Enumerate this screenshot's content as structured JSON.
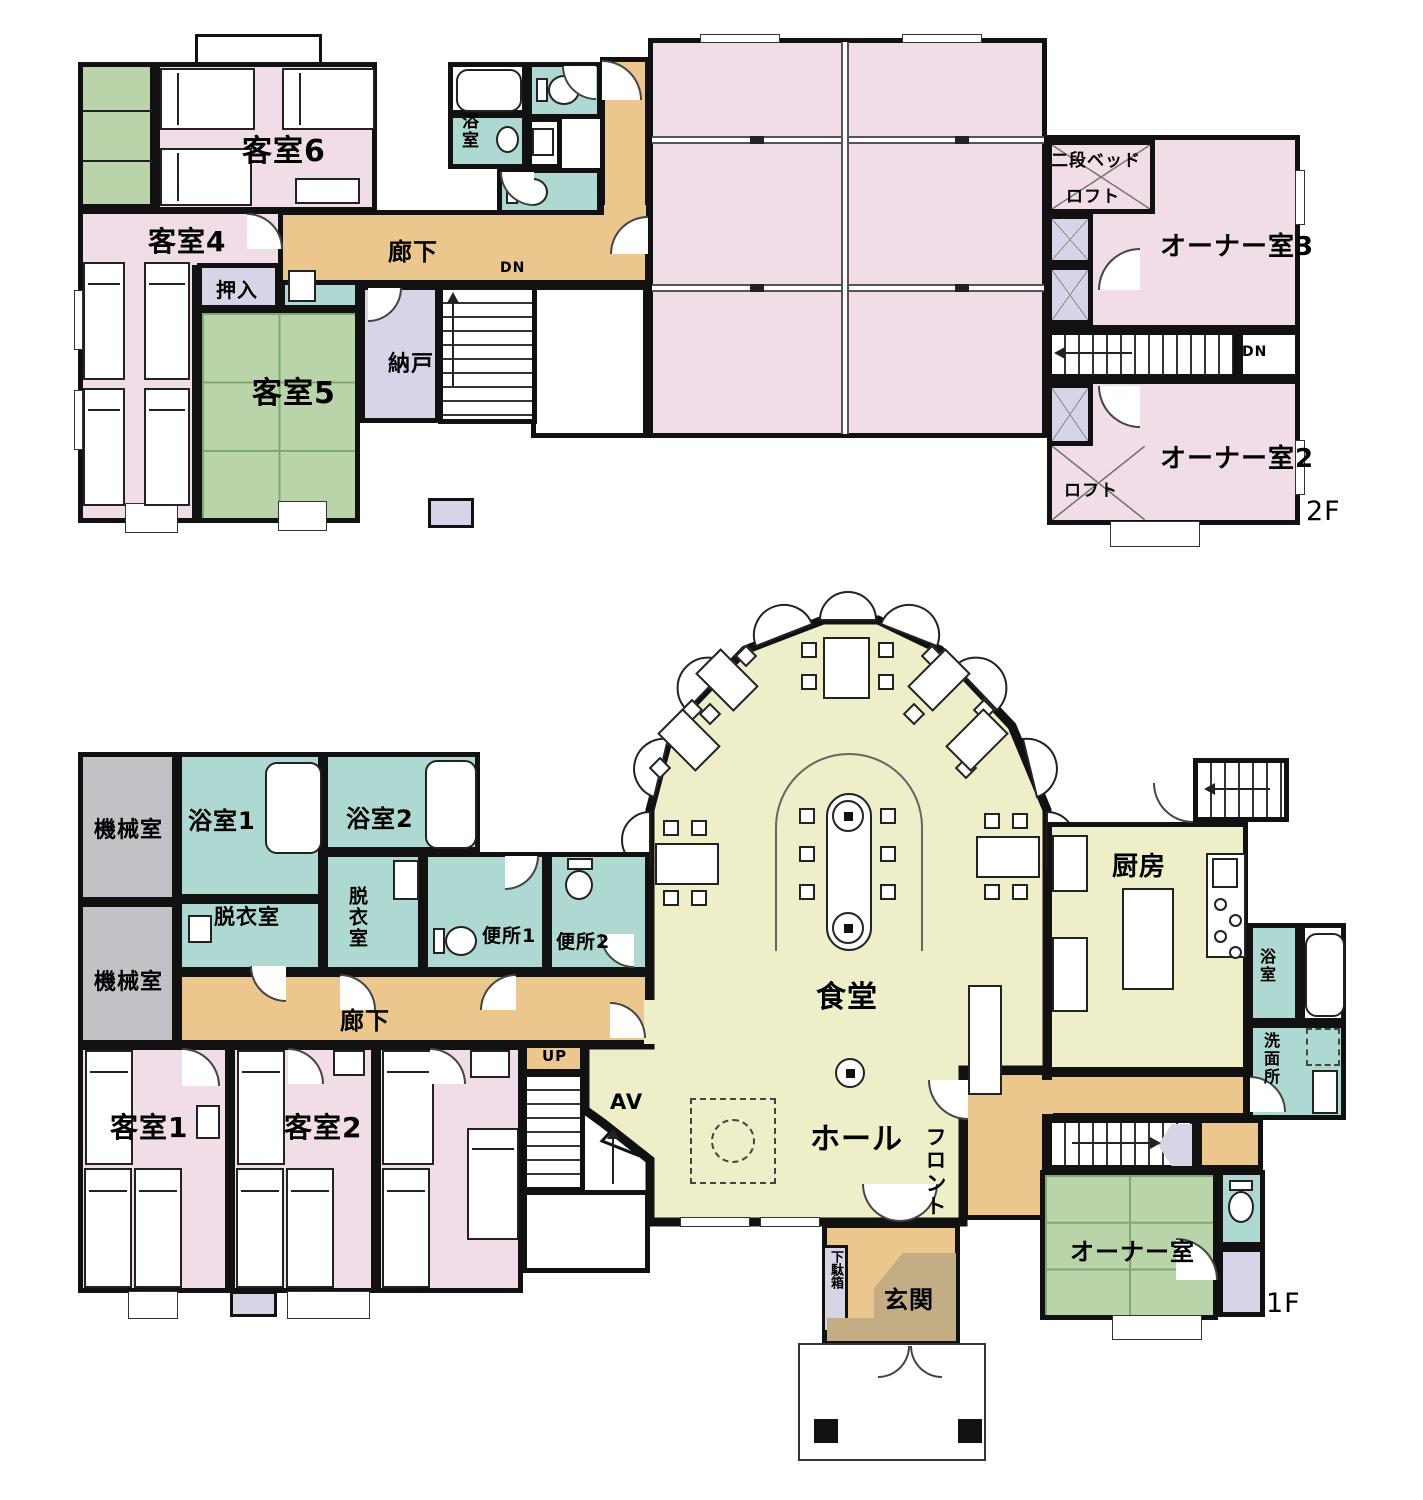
{
  "colors": {
    "wall": "#111111",
    "guest_room_pink": "#f0dde8",
    "tatami_green": "#b8d4a8",
    "bath_teal": "#aed8d2",
    "corridor_tan": "#ecc78d",
    "hall_yellow": "#eeefc8",
    "machine_gray": "#c2c1c6",
    "closet_lavender": "#d6d5e7",
    "entrance_brown": "#c2ad85"
  },
  "floor2": {
    "floor_label": "2F",
    "guest6": "客室6",
    "guest4": "客室4",
    "guest5": "客室5",
    "closet": "押入",
    "bath": "浴室",
    "corridor": "廊下",
    "storage": "納戸",
    "down_left": "DN",
    "bunk_bed": "二段ベッド",
    "loft_upper": "ロフト",
    "owner3": "オーナー室3",
    "down_right": "DN",
    "owner2": "オーナー室2",
    "loft_lower": "ロフト"
  },
  "floor1": {
    "floor_label": "1F",
    "machine1": "機械室",
    "machine2": "機械室",
    "bath1": "浴室1",
    "bath2": "浴室2",
    "dressing1": "脱衣室",
    "dressing2": "脱衣室",
    "toilet1": "便所1",
    "toilet2": "便所2",
    "corridor": "廊下",
    "guest1": "客室1",
    "guest2": "客室2",
    "up": "UP",
    "av": "AV",
    "dining": "食堂",
    "hall": "ホール",
    "front": "フロント",
    "kitchen": "厨房",
    "bath3": "浴室",
    "washroom": "洗面所",
    "owner": "オーナー室",
    "shoe_box": "下駄箱",
    "entrance": "玄関"
  }
}
